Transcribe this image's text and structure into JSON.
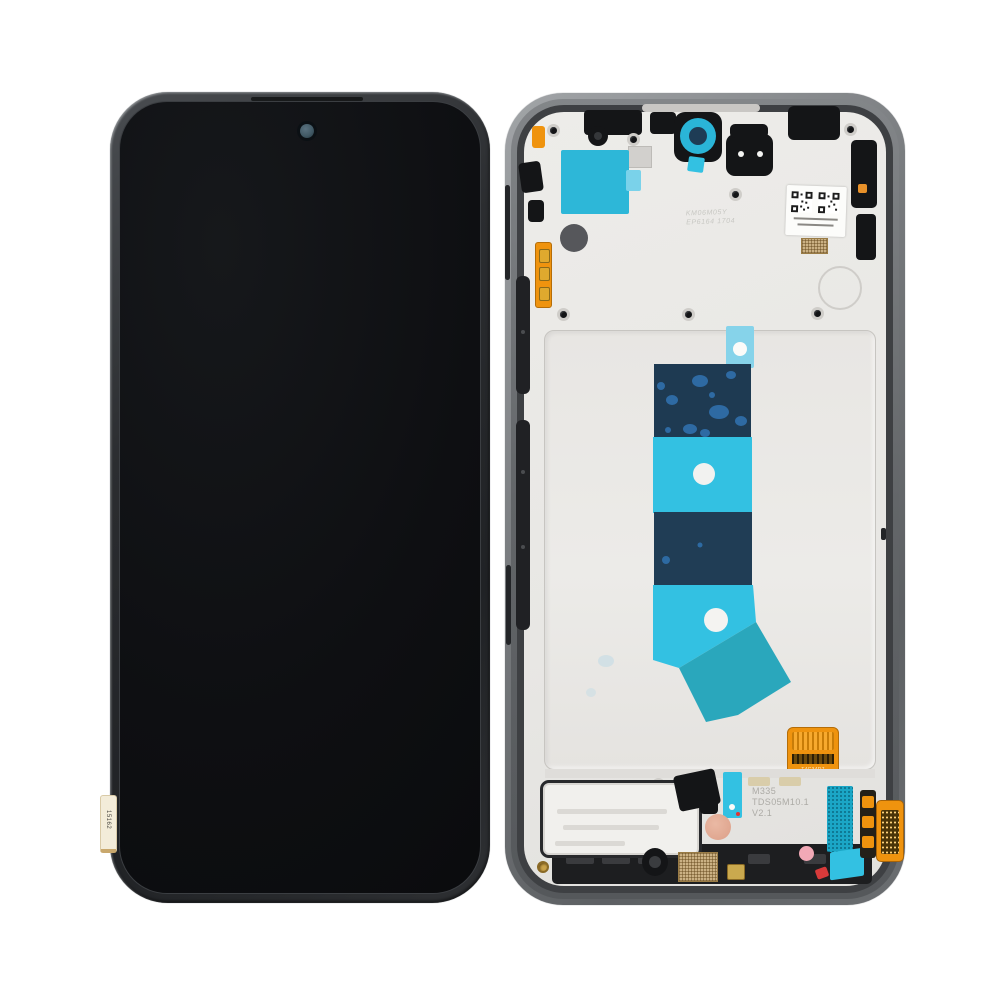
{
  "photo": {
    "subject": "Smartphone LCD display assembly with frame, front and rear views",
    "background_color": "#ffffff"
  },
  "front_assembly": {
    "frame_color": "#2c2f32",
    "screen_color": "#0e0f12",
    "camera_color": "#46606b",
    "qc_sticker": {
      "text": "15162",
      "color": "#f3ecd9"
    }
  },
  "rear_assembly": {
    "frame_color": "#7b7e81",
    "plate_color": "#e9e8e5",
    "colors": {
      "adhesive_cyan": "#33c1e2",
      "adhesive_navy": "#1e3a52",
      "adhesive_teal": "#2aa7bc",
      "sticker_cyan": "#2db7d8",
      "flex_orange": "#ef930e",
      "grille_gold": "#cbb184",
      "accent_pink": "#f2a9b6",
      "accent_salmon": "#e0a68f"
    },
    "markings": {
      "center_emboss_line1": "KM06M05Y",
      "center_emboss_line2": "EP6164 1704",
      "bottom_emboss_line1": "M335",
      "bottom_emboss_line2": "TDS05M10.1",
      "bottom_emboss_line3": "V2.1",
      "connector_label": "T4C34D7"
    }
  }
}
